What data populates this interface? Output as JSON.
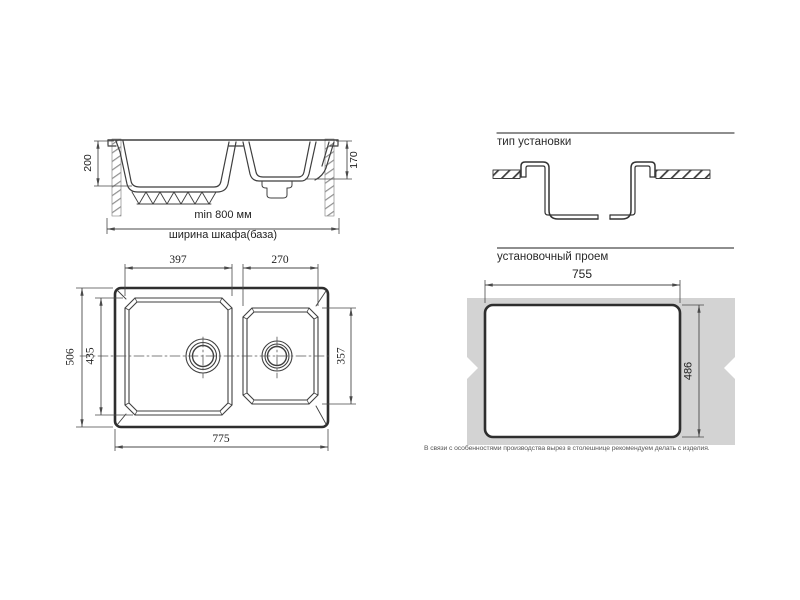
{
  "drawing": {
    "side_view": {
      "depth_main": "200",
      "depth_second": "170",
      "width_min": "min 800 мм",
      "width_caption": "ширина шкафа(база)"
    },
    "top_view": {
      "bowl1_width": "397",
      "bowl2_width": "270",
      "overall_depth": "506",
      "bowl1_depth": "435",
      "bowl2_depth": "357",
      "overall_width": "775"
    },
    "install_type": {
      "title": "тип установки"
    },
    "cutout": {
      "title": "установочный проем",
      "width": "755",
      "height": "486",
      "note": "В связи с особенностями производства вырез в столешнице рекомендуем делать с изделия."
    },
    "colors": {
      "line": "#3f3f3f",
      "heavy_line": "#2e2e2e",
      "dim_line": "#4a4a4a",
      "countertop_fill": "#d3d3d3",
      "hatch_light": "#8f8f8f"
    }
  }
}
